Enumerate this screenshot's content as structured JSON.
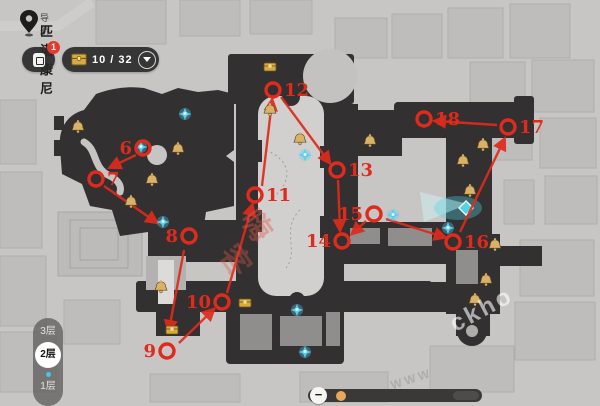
{
  "header": {
    "nav_label": "导航",
    "location_name": "匹诺康尼",
    "notice_badge": "1",
    "chest_counter": {
      "current": "10",
      "total": "32",
      "display": "10 / 32"
    }
  },
  "floor_selector": {
    "floors": [
      {
        "label": "3层",
        "active": false
      },
      {
        "label": "2层",
        "active": true
      },
      {
        "label": "1层",
        "active": false
      }
    ]
  },
  "zoom_slider": {
    "minus_label": "−"
  },
  "watermarks": [
    {
      "text": "嗨",
      "x": 243,
      "y": 203,
      "rotate": 55,
      "size": 30,
      "color": "#e05a4a",
      "opacity": 0.42
    },
    {
      "text": "客",
      "x": 222,
      "y": 238,
      "rotate": 55,
      "size": 30,
      "color": "#e05a4a",
      "opacity": 0.36
    },
    {
      "text": "ckho",
      "x": 448,
      "y": 296,
      "rotate": -28,
      "size": 24,
      "color": "#ffffff",
      "opacity": 0.6
    },
    {
      "text": "WWW",
      "x": 390,
      "y": 372,
      "rotate": -18,
      "size": 12,
      "color": "#9a9998",
      "opacity": 0.55
    }
  ],
  "colors": {
    "marker_red": "#df2b1d",
    "gold": "#d9b168",
    "chest_gold": "#d8a93e",
    "sprite_cyan": "#58cdf2",
    "waypoint_cyan": "#4fd4e6"
  },
  "map": {
    "markers": [
      {
        "n": "6",
        "cx": 143,
        "cy": 148,
        "label_side": "left"
      },
      {
        "n": "7",
        "cx": 96,
        "cy": 179,
        "label_side": "right"
      },
      {
        "n": "8",
        "cx": 189,
        "cy": 236,
        "label_side": "left"
      },
      {
        "n": "9",
        "cx": 167,
        "cy": 351,
        "label_side": "left"
      },
      {
        "n": "10",
        "cx": 222,
        "cy": 302,
        "label_side": "left"
      },
      {
        "n": "11",
        "cx": 255,
        "cy": 195,
        "label_side": "right"
      },
      {
        "n": "12",
        "cx": 273,
        "cy": 90,
        "label_side": "right"
      },
      {
        "n": "13",
        "cx": 337,
        "cy": 170,
        "label_side": "right"
      },
      {
        "n": "14",
        "cx": 342,
        "cy": 241,
        "label_side": "left"
      },
      {
        "n": "15",
        "cx": 374,
        "cy": 214,
        "label_side": "left"
      },
      {
        "n": "16",
        "cx": 453,
        "cy": 242,
        "label_side": "right"
      },
      {
        "n": "17",
        "cx": 508,
        "cy": 127,
        "label_side": "right"
      },
      {
        "n": "18",
        "cx": 424,
        "cy": 119,
        "label_side": "right"
      }
    ],
    "routes": [
      {
        "from": "6",
        "to": "7",
        "x1": 136,
        "y1": 155,
        "x2": 111,
        "y2": 167
      },
      {
        "from": "7",
        "to": "8",
        "x1": 104,
        "y1": 186,
        "x2": 156,
        "y2": 222
      },
      {
        "from": "8",
        "to": "9",
        "x1": 184,
        "y1": 250,
        "x2": 169,
        "y2": 330
      },
      {
        "from": "9",
        "to": "10",
        "x1": 179,
        "y1": 343,
        "x2": 213,
        "y2": 310
      },
      {
        "from": "10",
        "to": "11",
        "x1": 227,
        "y1": 293,
        "x2": 252,
        "y2": 206
      },
      {
        "from": "11",
        "to": "12",
        "x1": 262,
        "y1": 186,
        "x2": 272,
        "y2": 101
      },
      {
        "from": "12",
        "to": "13",
        "x1": 281,
        "y1": 97,
        "x2": 329,
        "y2": 162
      },
      {
        "from": "13",
        "to": "14",
        "x1": 338,
        "y1": 180,
        "x2": 340,
        "y2": 229
      },
      {
        "from": "15",
        "to": "14",
        "x1": 366,
        "y1": 221,
        "x2": 353,
        "y2": 233
      },
      {
        "from": "15",
        "to": "16",
        "x1": 386,
        "y1": 219,
        "x2": 444,
        "y2": 237
      },
      {
        "from": "16",
        "to": "17",
        "x1": 460,
        "y1": 232,
        "x2": 504,
        "y2": 140
      },
      {
        "from": "17",
        "to": "18",
        "x1": 497,
        "y1": 125,
        "x2": 436,
        "y2": 121
      }
    ],
    "bells": [
      {
        "x": 78,
        "y": 127
      },
      {
        "x": 178,
        "y": 149
      },
      {
        "x": 152,
        "y": 180
      },
      {
        "x": 131,
        "y": 202
      },
      {
        "x": 161,
        "y": 287
      },
      {
        "x": 270,
        "y": 110
      },
      {
        "x": 300,
        "y": 139
      },
      {
        "x": 370,
        "y": 141
      },
      {
        "x": 483,
        "y": 145
      },
      {
        "x": 463,
        "y": 161
      },
      {
        "x": 470,
        "y": 191
      },
      {
        "x": 495,
        "y": 245
      },
      {
        "x": 486,
        "y": 280
      },
      {
        "x": 475,
        "y": 300
      }
    ],
    "chests": [
      {
        "x": 270,
        "y": 67
      },
      {
        "x": 245,
        "y": 303
      },
      {
        "x": 172,
        "y": 330
      }
    ],
    "sprites": [
      {
        "x": 185,
        "y": 114
      },
      {
        "x": 141,
        "y": 147
      },
      {
        "x": 163,
        "y": 222
      },
      {
        "x": 305,
        "y": 155
      },
      {
        "x": 393,
        "y": 215
      },
      {
        "x": 448,
        "y": 228
      },
      {
        "x": 297,
        "y": 310
      },
      {
        "x": 305,
        "y": 352
      }
    ],
    "waypoint": {
      "x": 466,
      "y": 208
    }
  }
}
